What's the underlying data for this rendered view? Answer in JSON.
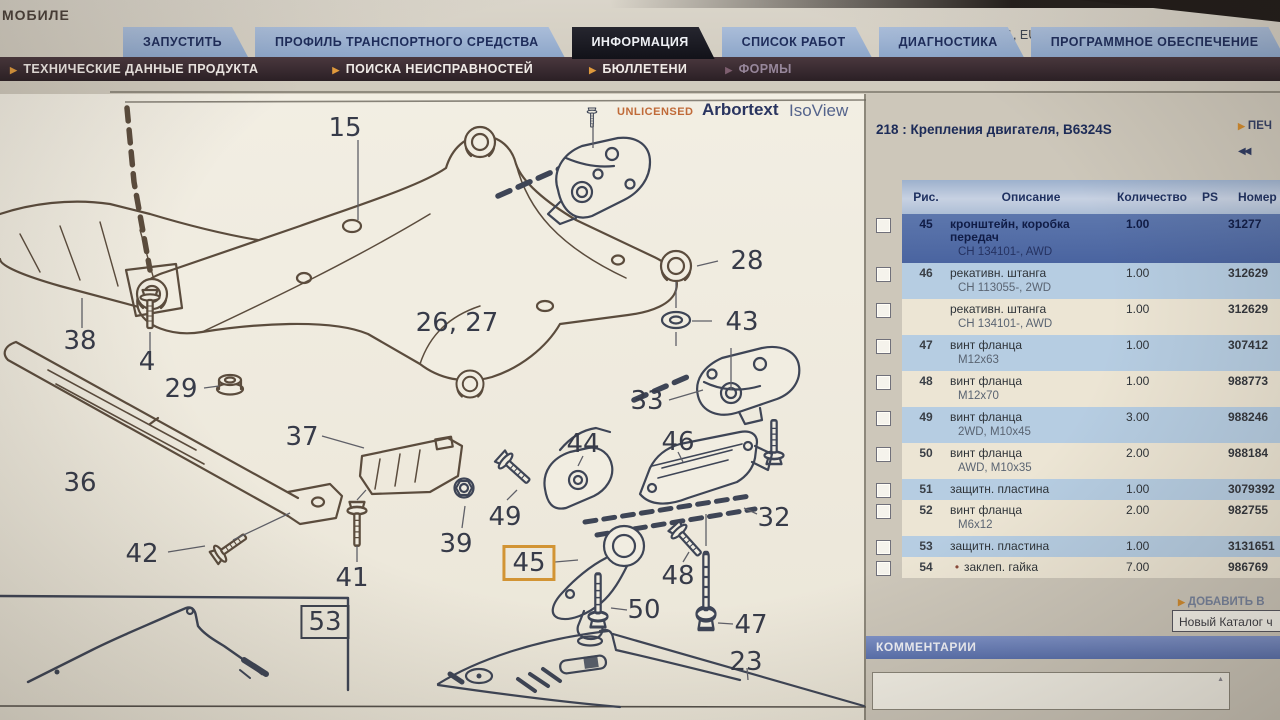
{
  "window": {
    "brand": "МОБИЛЕ",
    "currency": "1, EUR",
    "logout": "ВЫЙТИ ИЗ СИСТ"
  },
  "tabs": [
    {
      "label": "ЗАПУСТИТЬ",
      "active": false
    },
    {
      "label": "ПРОФИЛЬ ТРАНСПОРТНОГО СРЕДСТВА",
      "active": false
    },
    {
      "label": "ИНФОРМАЦИЯ",
      "active": true
    },
    {
      "label": "СПИСОК РАБОТ",
      "active": false
    },
    {
      "label": "ДИАГНОСТИКА",
      "active": false
    },
    {
      "label": "ПРОГРАММНОЕ ОБЕСПЕЧЕНИЕ",
      "active": false
    }
  ],
  "subnav": [
    {
      "label": "ТЕХНИЧЕСКИЕ ДАННЫЕ ПРОДУКТА",
      "muted": false
    },
    {
      "label": "ПОИСКА НЕИСПРАВНОСТЕЙ",
      "muted": false
    },
    {
      "label": "БЮЛЛЕТЕНИ",
      "muted": false
    },
    {
      "label": "ФОРМЫ",
      "muted": true
    }
  ],
  "viewer": {
    "unlicensed": "UNLICENSED",
    "brand": "Arbortext",
    "product": "IsoView"
  },
  "diagram": {
    "labels": [
      {
        "text": "15",
        "x": 345,
        "y": 128
      },
      {
        "text": "28",
        "x": 747,
        "y": 261
      },
      {
        "text": "26, 27",
        "x": 457,
        "y": 323
      },
      {
        "text": "43",
        "x": 742,
        "y": 322
      },
      {
        "text": "38",
        "x": 80,
        "y": 341
      },
      {
        "text": "4",
        "x": 147,
        "y": 362
      },
      {
        "text": "29",
        "x": 181,
        "y": 389
      },
      {
        "text": "33",
        "x": 647,
        "y": 401
      },
      {
        "text": "37",
        "x": 302,
        "y": 437
      },
      {
        "text": "44",
        "x": 583,
        "y": 444
      },
      {
        "text": "46",
        "x": 678,
        "y": 442
      },
      {
        "text": "36",
        "x": 80,
        "y": 483
      },
      {
        "text": "49",
        "x": 505,
        "y": 517
      },
      {
        "text": "32",
        "x": 774,
        "y": 518
      },
      {
        "text": "39",
        "x": 456,
        "y": 544
      },
      {
        "text": "45",
        "x": 529,
        "y": 563,
        "style": "highlight"
      },
      {
        "text": "42",
        "x": 142,
        "y": 554
      },
      {
        "text": "48",
        "x": 678,
        "y": 576
      },
      {
        "text": "41",
        "x": 352,
        "y": 578
      },
      {
        "text": "50",
        "x": 644,
        "y": 610
      },
      {
        "text": "47",
        "x": 751,
        "y": 625
      },
      {
        "text": "53",
        "x": 325,
        "y": 622,
        "style": "boxed"
      },
      {
        "text": "23",
        "x": 746,
        "y": 662
      }
    ],
    "highlight_color": "#d29434"
  },
  "panel": {
    "title": "218 : Крепления двигателя, B6324S",
    "print_label": "ПЕЧ",
    "back_icon": "◀◀",
    "add_label": "ДОБАВИТЬ В",
    "catalog_value": "Новый Каталог ч",
    "comments_title": "КОММЕНТАРИИ",
    "table": {
      "headers": {
        "fig": "Рис.",
        "desc": "Описание",
        "qty": "Количество",
        "ps": "PS",
        "part": "Номер части"
      },
      "rows": [
        {
          "fig": "45",
          "desc": "кронштейн, коробка передач",
          "sub": "CH 134101-, AWD",
          "qty": "1.00",
          "ps": "",
          "part": "31277",
          "selected": true
        },
        {
          "fig": "46",
          "desc": "рекативн. штанга",
          "sub": "CH 113055-, 2WD",
          "qty": "1.00",
          "ps": "",
          "part": "312629"
        },
        {
          "fig": "",
          "desc": "рекативн. штанга",
          "sub": "CH 134101-, AWD",
          "qty": "1.00",
          "ps": "",
          "part": "312629"
        },
        {
          "fig": "47",
          "desc": "винт фланца",
          "sub": "M12x63",
          "qty": "1.00",
          "ps": "",
          "part": "307412"
        },
        {
          "fig": "48",
          "desc": "винт фланца",
          "sub": "M12x70",
          "qty": "1.00",
          "ps": "",
          "part": "988773"
        },
        {
          "fig": "49",
          "desc": "винт фланца",
          "sub": "2WD, M10x45",
          "qty": "3.00",
          "ps": "",
          "part": "988246"
        },
        {
          "fig": "50",
          "desc": "винт фланца",
          "sub": "AWD, M10x35",
          "qty": "2.00",
          "ps": "",
          "part": "988184"
        },
        {
          "fig": "51",
          "desc": "защитн. пластина",
          "sub": "",
          "qty": "1.00",
          "ps": "",
          "part": "3079392"
        },
        {
          "fig": "52",
          "desc": "винт фланца",
          "sub": "M6x12",
          "qty": "2.00",
          "ps": "",
          "part": "982755"
        },
        {
          "fig": "53",
          "desc": "защитн. пластина",
          "sub": "",
          "qty": "1.00",
          "ps": "",
          "part": "3131651"
        },
        {
          "fig": "54",
          "desc": "заклеп. гайка",
          "sub": "",
          "qty": "7.00",
          "ps": "",
          "part": "986769",
          "bullet": true
        }
      ]
    }
  }
}
